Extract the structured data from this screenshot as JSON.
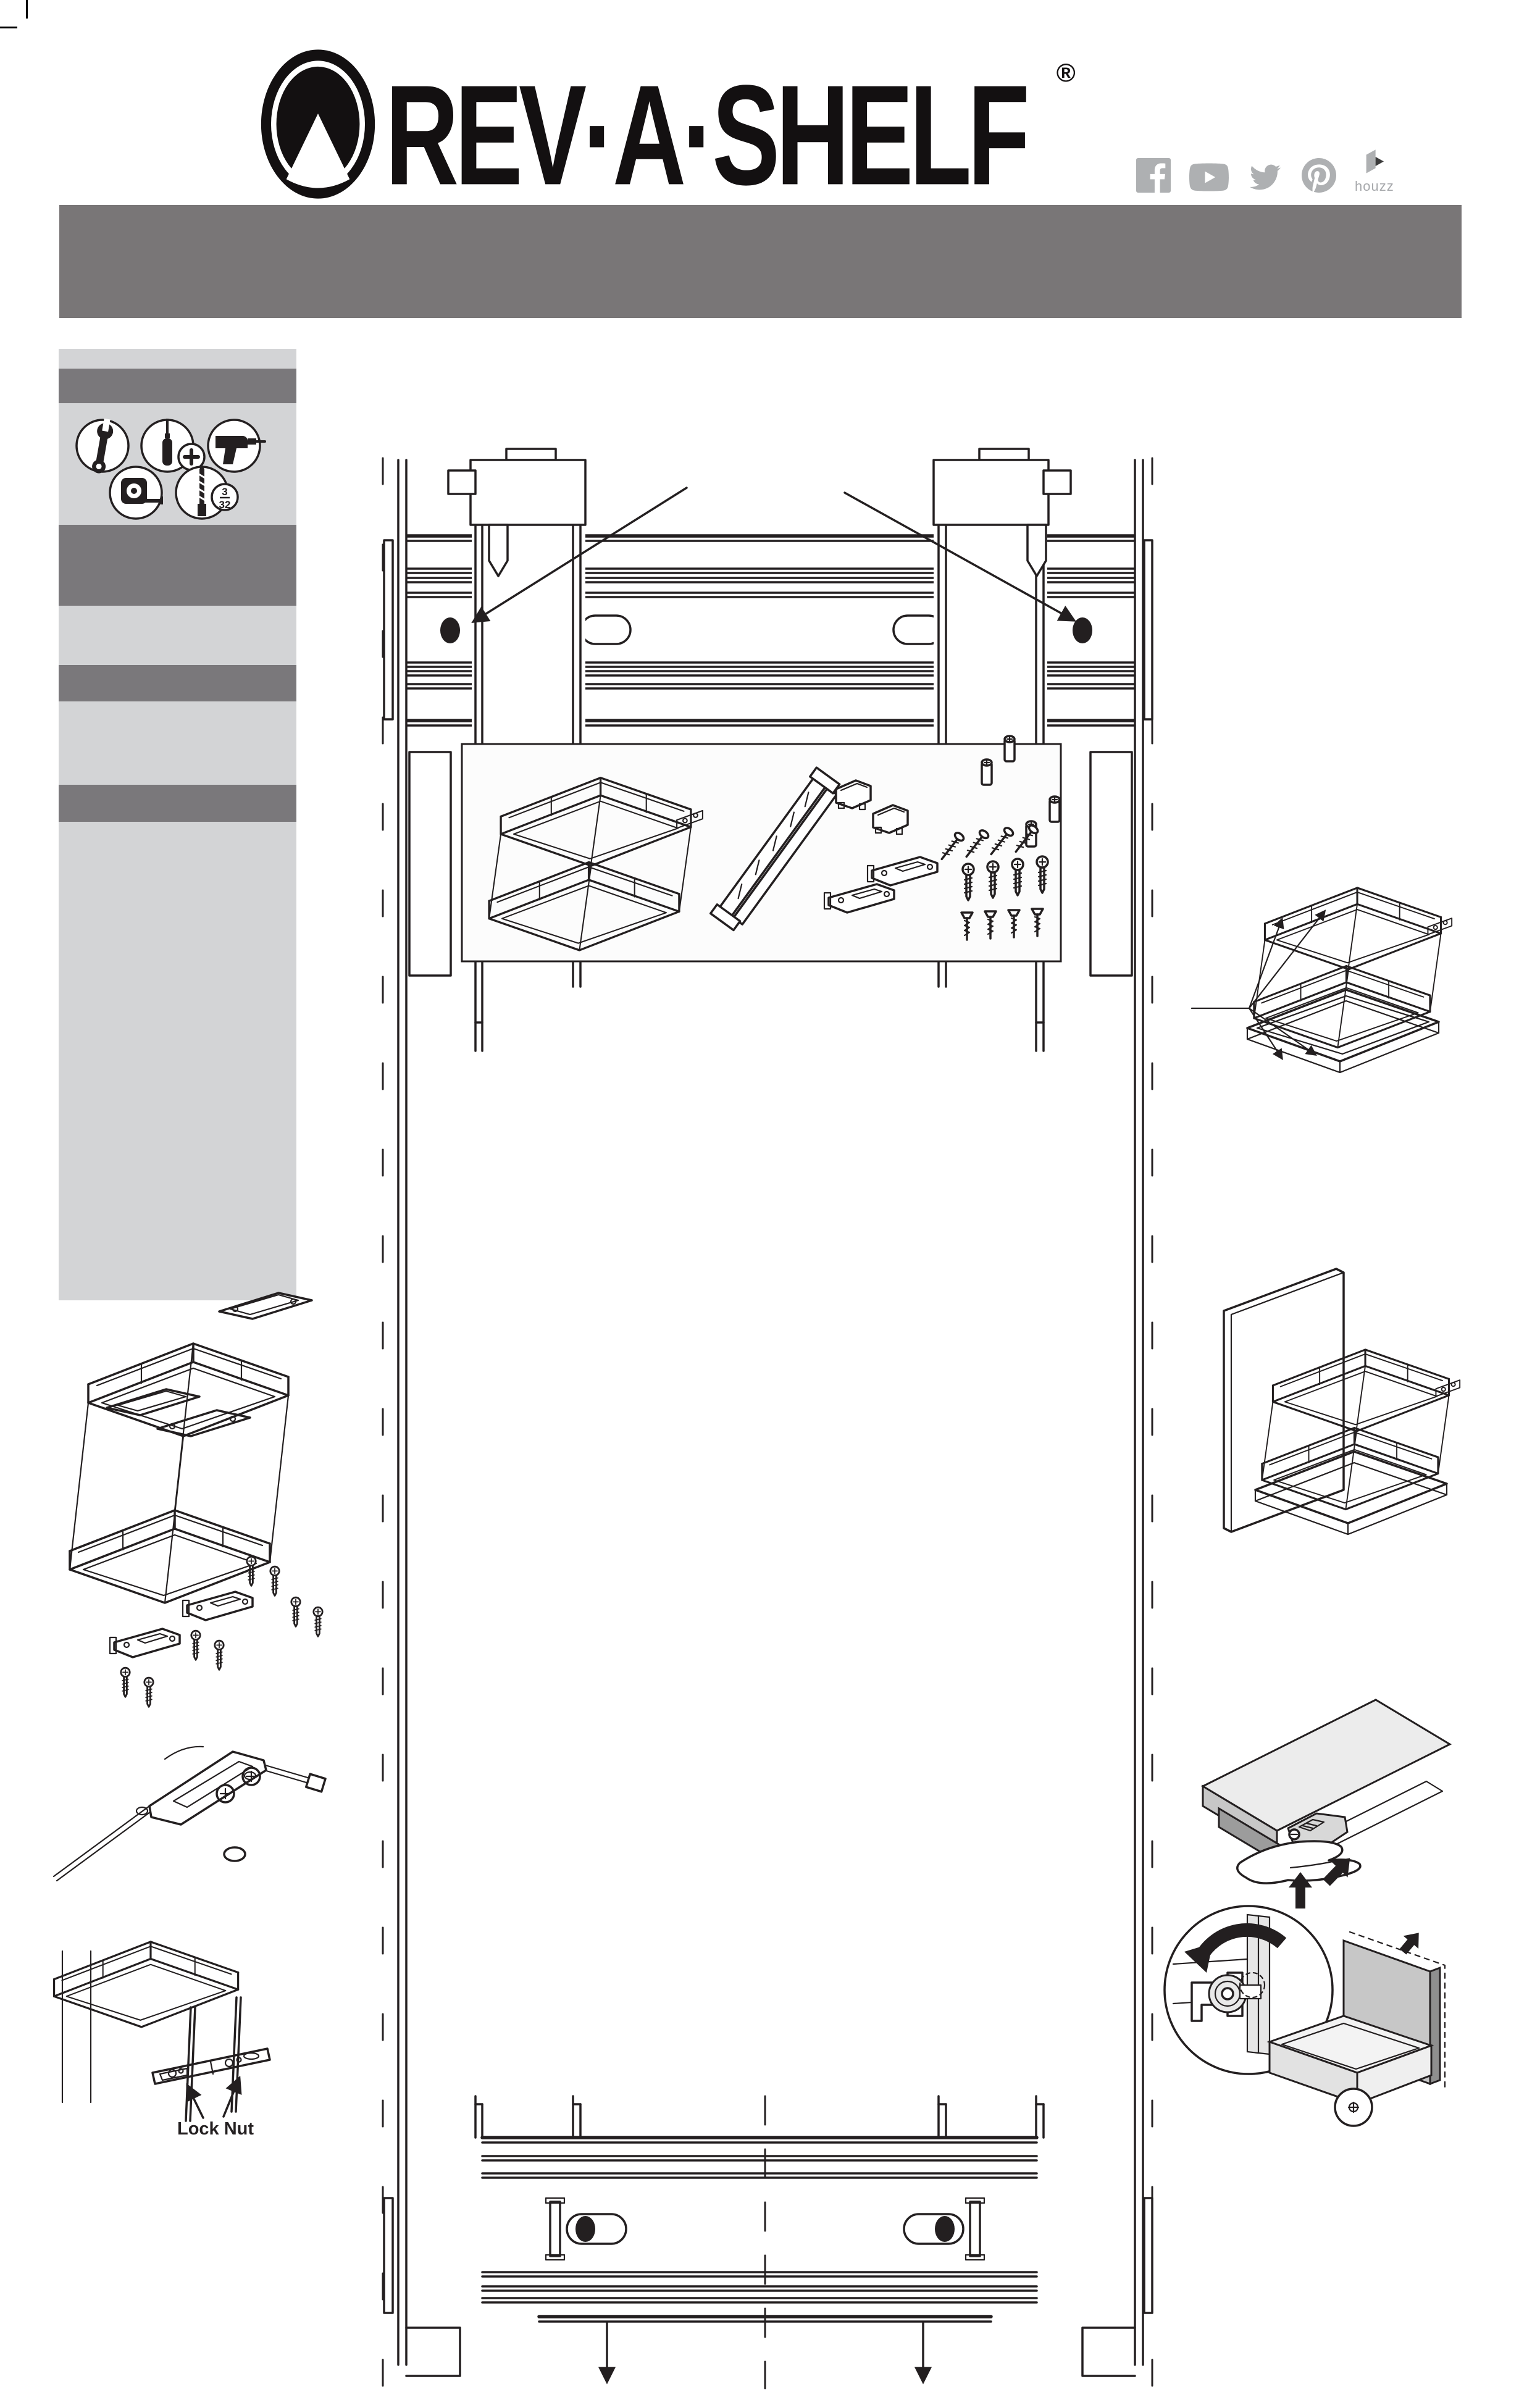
{
  "header": {
    "logo_text": "REV·A·SHELF",
    "registered_mark": "®",
    "social": {
      "houzz_label": "houzz",
      "icon_names": [
        "facebook-icon",
        "youtube-icon",
        "twitter-icon",
        "pinterest-icon",
        "houzz-icon"
      ]
    }
  },
  "banner": {
    "text": "",
    "color": "#797677"
  },
  "sidebar": {
    "tool_icons": [
      "wrench-icon",
      "phillips-screwdriver-icon",
      "drill-icon",
      "tape-measure-icon",
      "drill-bit-icon"
    ],
    "drill_bit_size": {
      "numerator": "3",
      "denominator": "32"
    }
  },
  "diagrams": {
    "lock_nut_label": "Lock Nut",
    "names": [
      "cabinet-elevation-drawing",
      "parts-box",
      "exploded-basket-diagram",
      "bracket-closeup-diagram",
      "lock-nut-diagram",
      "basket-callout-diagram",
      "basket-panel-diagram",
      "slide-lock-diagram",
      "cam-detail-diagram"
    ]
  },
  "colors": {
    "line": "#231f20",
    "banner_gray": "#797677",
    "sidebar_light": "#d3d4d6",
    "sidebar_dark": "#7a787b",
    "icon_gray": "#aeb0b2",
    "panel_light": "#ececec",
    "panel_mid": "#c7c7c7",
    "panel_dark": "#9c9c9c"
  }
}
